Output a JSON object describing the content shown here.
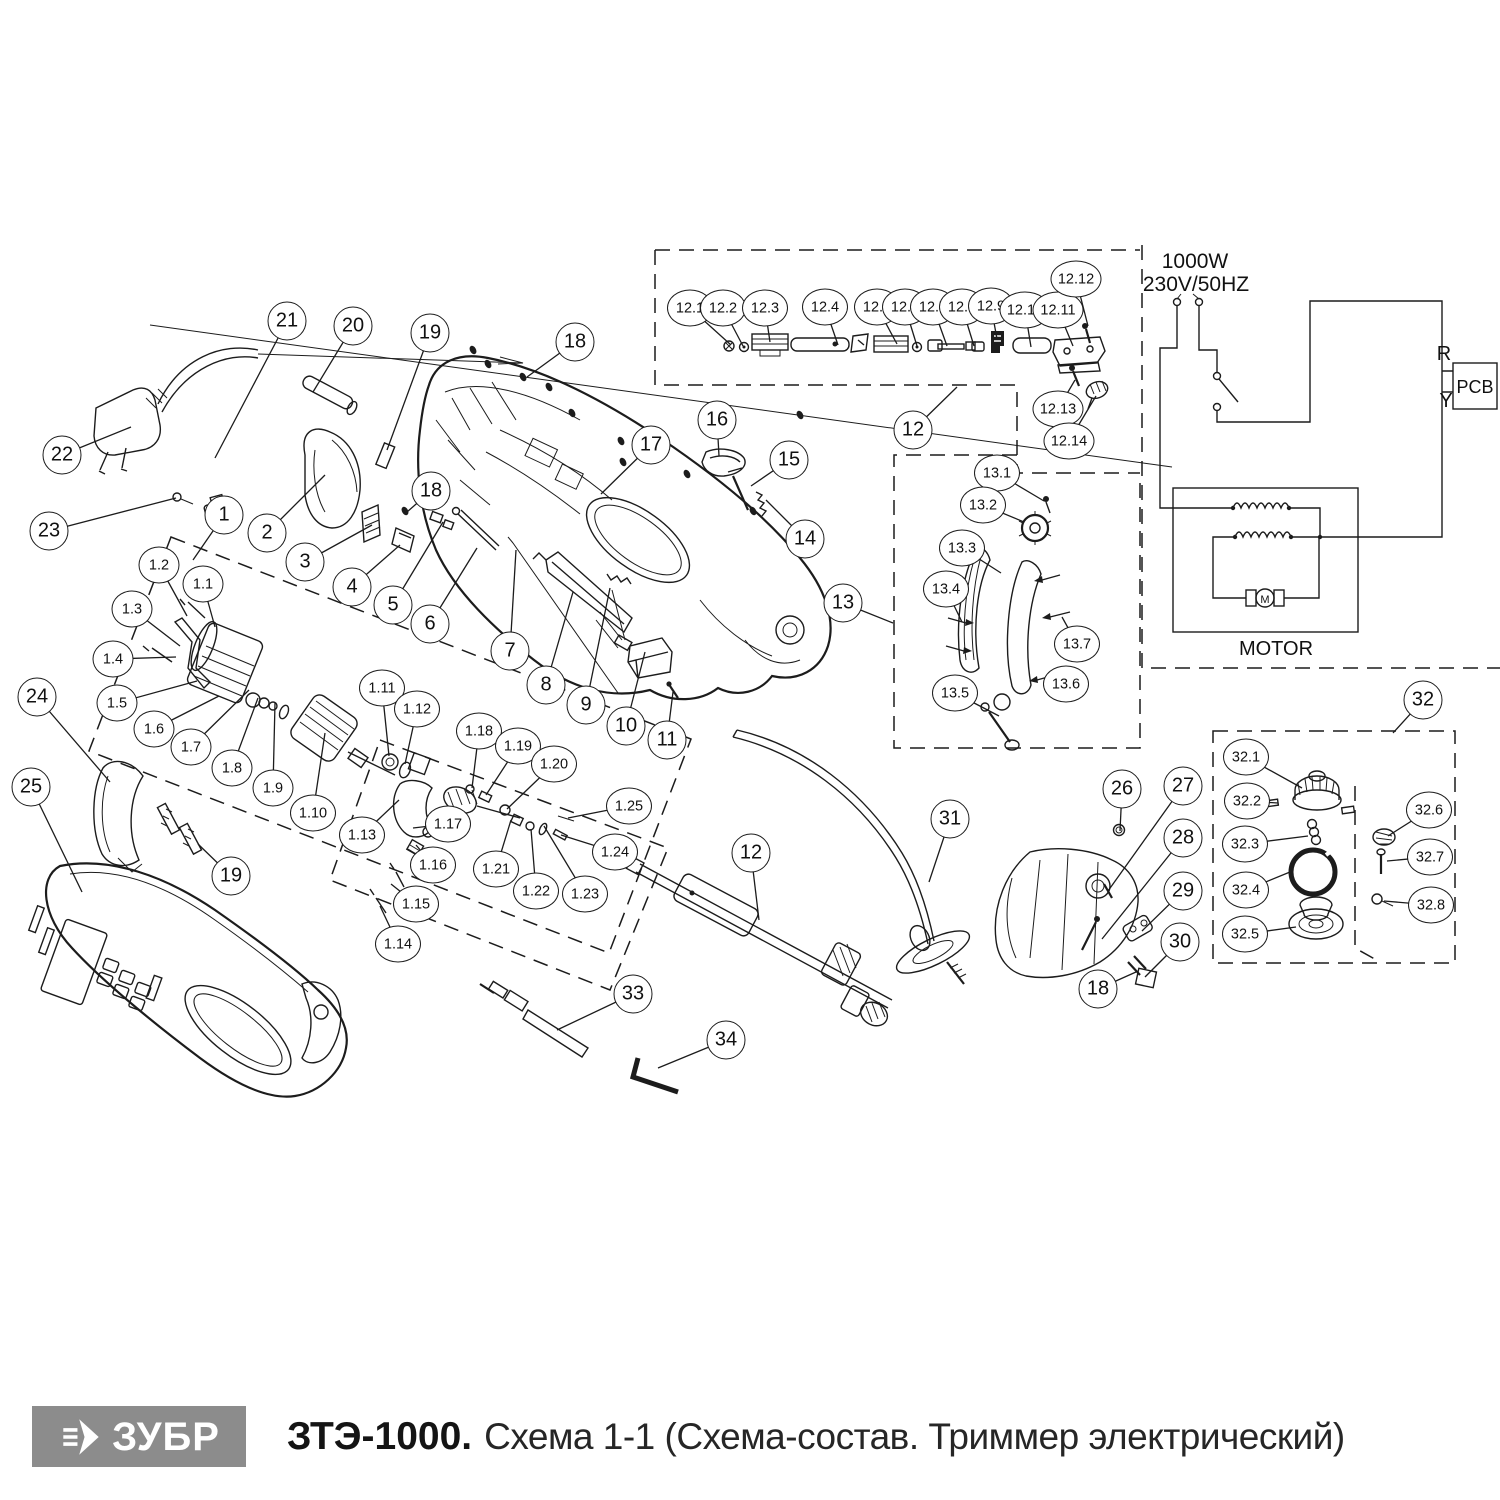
{
  "footer": {
    "brand": "ЗУБР",
    "model": "ЗТЭ-1000.",
    "subtitle": "Схема 1-1 (Схема-состав. Триммер электрический)"
  },
  "schematic": {
    "power": "1000W",
    "voltage": "230V/50HZ",
    "r_label": "R",
    "y_label": "Y",
    "pcb_label": "PCB",
    "motor_label": "MOTOR",
    "motor_symbol": "M"
  },
  "colors": {
    "line": "#1c1c1c",
    "logo_bg": "#8c8c8c",
    "background": "#ffffff"
  },
  "callouts": [
    {
      "label": "1",
      "x": 224,
      "y": 515,
      "tx": 193,
      "ty": 560
    },
    {
      "label": "2",
      "x": 267,
      "y": 533,
      "tx": 325,
      "ty": 475
    },
    {
      "label": "3",
      "x": 305,
      "y": 562,
      "tx": 372,
      "ty": 525
    },
    {
      "label": "4",
      "x": 352,
      "y": 587,
      "tx": 400,
      "ty": 545
    },
    {
      "label": "5",
      "x": 393,
      "y": 605,
      "tx": 443,
      "ty": 522
    },
    {
      "label": "6",
      "x": 430,
      "y": 624,
      "tx": 477,
      "ty": 548
    },
    {
      "label": "7",
      "x": 510,
      "y": 651,
      "tx": 516,
      "ty": 550
    },
    {
      "label": "8",
      "x": 546,
      "y": 685,
      "tx": 573,
      "ty": 592
    },
    {
      "label": "9",
      "x": 586,
      "y": 705,
      "tx": 610,
      "ty": 588
    },
    {
      "label": "10",
      "x": 626,
      "y": 726,
      "tx": 645,
      "ty": 652
    },
    {
      "label": "11",
      "x": 667,
      "y": 740,
      "tx": 673,
      "ty": 692
    },
    {
      "label": "12",
      "x": 913,
      "y": 430,
      "tx": 957,
      "ty": 387
    },
    {
      "label": "12",
      "x": 751,
      "y": 853,
      "tx": 759,
      "ty": 920
    },
    {
      "label": "13",
      "x": 843,
      "y": 603,
      "tx": 893,
      "ty": 623
    },
    {
      "label": "14",
      "x": 805,
      "y": 539,
      "tx": 766,
      "ty": 500
    },
    {
      "label": "15",
      "x": 789,
      "y": 460,
      "tx": 751,
      "ty": 486
    },
    {
      "label": "16",
      "x": 717,
      "y": 420,
      "tx": 719,
      "ty": 456
    },
    {
      "label": "17",
      "x": 651,
      "y": 445,
      "tx": 601,
      "ty": 494
    },
    {
      "label": "18",
      "x": 575,
      "y": 342,
      "tx": 527,
      "ty": 377
    },
    {
      "label": "18",
      "x": 431,
      "y": 491,
      "tx": 407,
      "ty": 512
    },
    {
      "label": "18",
      "x": 1098,
      "y": 989,
      "tx": 1136,
      "ty": 972
    },
    {
      "label": "19",
      "x": 430,
      "y": 333,
      "tx": 387,
      "ty": 450
    },
    {
      "label": "19",
      "x": 231,
      "y": 876,
      "tx": 198,
      "ty": 844
    },
    {
      "label": "20",
      "x": 353,
      "y": 326,
      "tx": 313,
      "ty": 392
    },
    {
      "label": "21",
      "x": 287,
      "y": 321,
      "tx": 215,
      "ty": 458
    },
    {
      "label": "22",
      "x": 62,
      "y": 455,
      "tx": 131,
      "ty": 427
    },
    {
      "label": "23",
      "x": 49,
      "y": 531,
      "tx": 176,
      "ty": 498
    },
    {
      "label": "24",
      "x": 37,
      "y": 697,
      "tx": 110,
      "ty": 782
    },
    {
      "label": "25",
      "x": 31,
      "y": 787,
      "tx": 82,
      "ty": 892
    },
    {
      "label": "26",
      "x": 1122,
      "y": 789,
      "tx": 1120,
      "ty": 831
    },
    {
      "label": "27",
      "x": 1183,
      "y": 786,
      "tx": 1108,
      "ty": 891
    },
    {
      "label": "28",
      "x": 1183,
      "y": 838,
      "tx": 1102,
      "ty": 939
    },
    {
      "label": "29",
      "x": 1183,
      "y": 891,
      "tx": 1142,
      "ty": 931
    },
    {
      "label": "30",
      "x": 1180,
      "y": 942,
      "tx": 1145,
      "ty": 977
    },
    {
      "label": "31",
      "x": 950,
      "y": 819,
      "tx": 929,
      "ty": 882
    },
    {
      "label": "32",
      "x": 1423,
      "y": 700,
      "tx": 1393,
      "ty": 733
    },
    {
      "label": "33",
      "x": 633,
      "y": 994,
      "tx": 557,
      "ty": 1030
    },
    {
      "label": "34",
      "x": 726,
      "y": 1040,
      "tx": 658,
      "ty": 1068
    },
    {
      "label": "1.1",
      "x": 203,
      "y": 584,
      "tx": 215,
      "ty": 627
    },
    {
      "label": "1.2",
      "x": 159,
      "y": 565,
      "tx": 187,
      "ty": 616
    },
    {
      "label": "1.3",
      "x": 132,
      "y": 609,
      "tx": 180,
      "ty": 646
    },
    {
      "label": "1.4",
      "x": 113,
      "y": 659,
      "tx": 176,
      "ty": 657
    },
    {
      "label": "1.5",
      "x": 117,
      "y": 703,
      "tx": 197,
      "ty": 681
    },
    {
      "label": "1.6",
      "x": 154,
      "y": 729,
      "tx": 219,
      "ty": 696
    },
    {
      "label": "1.7",
      "x": 191,
      "y": 747,
      "tx": 249,
      "ty": 690
    },
    {
      "label": "1.8",
      "x": 232,
      "y": 768,
      "tx": 258,
      "ty": 698
    },
    {
      "label": "1.9",
      "x": 273,
      "y": 788,
      "tx": 275,
      "ty": 703
    },
    {
      "label": "1.10",
      "x": 313,
      "y": 813,
      "tx": 325,
      "ty": 733
    },
    {
      "label": "1.11",
      "x": 382,
      "y": 688,
      "tx": 389,
      "ty": 756
    },
    {
      "label": "1.12",
      "x": 417,
      "y": 709,
      "tx": 405,
      "ty": 764
    },
    {
      "label": "1.13",
      "x": 362,
      "y": 835,
      "tx": 399,
      "ty": 800
    },
    {
      "label": "1.14",
      "x": 398,
      "y": 944,
      "tx": 380,
      "ty": 906
    },
    {
      "label": "1.15",
      "x": 416,
      "y": 904,
      "tx": 391,
      "ty": 884
    },
    {
      "label": "1.16",
      "x": 433,
      "y": 865,
      "tx": 416,
      "ty": 845
    },
    {
      "label": "1.17",
      "x": 448,
      "y": 824,
      "tx": 413,
      "ty": 828
    },
    {
      "label": "1.18",
      "x": 479,
      "y": 731,
      "tx": 472,
      "ty": 788
    },
    {
      "label": "1.19",
      "x": 518,
      "y": 746,
      "tx": 486,
      "ty": 795
    },
    {
      "label": "1.20",
      "x": 554,
      "y": 764,
      "tx": 507,
      "ty": 809
    },
    {
      "label": "1.21",
      "x": 496,
      "y": 869,
      "tx": 511,
      "ty": 820
    },
    {
      "label": "1.22",
      "x": 536,
      "y": 891,
      "tx": 531,
      "ty": 829
    },
    {
      "label": "1.23",
      "x": 585,
      "y": 894,
      "tx": 544,
      "ty": 826
    },
    {
      "label": "1.24",
      "x": 615,
      "y": 852,
      "tx": 561,
      "ty": 835
    },
    {
      "label": "1.25",
      "x": 629,
      "y": 806,
      "tx": 568,
      "ty": 818
    },
    {
      "label": "12.1",
      "x": 690,
      "y": 308,
      "tx": 731,
      "ty": 345
    },
    {
      "label": "12.2",
      "x": 723,
      "y": 308,
      "tx": 743,
      "ty": 346
    },
    {
      "label": "12.3",
      "x": 765,
      "y": 308,
      "tx": 770,
      "ty": 342
    },
    {
      "label": "12.4",
      "x": 825,
      "y": 307,
      "tx": 838,
      "ty": 345
    },
    {
      "label": "12.5",
      "x": 877,
      "y": 307,
      "tx": 897,
      "ty": 344
    },
    {
      "label": "12.6",
      "x": 905,
      "y": 307,
      "tx": 917,
      "ty": 346
    },
    {
      "label": "12.7",
      "x": 933,
      "y": 307,
      "tx": 947,
      "ty": 346
    },
    {
      "label": "12.8",
      "x": 962,
      "y": 307,
      "tx": 974,
      "ty": 346
    },
    {
      "label": "12.9",
      "x": 991,
      "y": 306,
      "tx": 997,
      "ty": 339
    },
    {
      "label": "12.10",
      "x": 1025,
      "y": 310,
      "tx": 1031,
      "ty": 347
    },
    {
      "label": "12.11",
      "x": 1058,
      "y": 310,
      "tx": 1073,
      "ty": 346
    },
    {
      "label": "12.12",
      "x": 1076,
      "y": 279,
      "tx": 1088,
      "ty": 326
    },
    {
      "label": "12.13",
      "x": 1058,
      "y": 409,
      "tx": 1075,
      "ty": 380
    },
    {
      "label": "12.14",
      "x": 1069,
      "y": 441,
      "tx": 1096,
      "ty": 396
    },
    {
      "label": "13.1",
      "x": 997,
      "y": 473,
      "tx": 1044,
      "ty": 501
    },
    {
      "label": "13.2",
      "x": 983,
      "y": 505,
      "tx": 1024,
      "ty": 522
    },
    {
      "label": "13.3",
      "x": 962,
      "y": 548,
      "tx": 1001,
      "ty": 573
    },
    {
      "label": "13.4",
      "x": 946,
      "y": 589,
      "tx": 962,
      "ty": 622
    },
    {
      "label": "13.5",
      "x": 955,
      "y": 693,
      "tx": 999,
      "ty": 716
    },
    {
      "label": "13.6",
      "x": 1066,
      "y": 684,
      "tx": 1047,
      "ty": 675
    },
    {
      "label": "13.7",
      "x": 1077,
      "y": 644,
      "tx": 1062,
      "ty": 617
    },
    {
      "label": "32.1",
      "x": 1246,
      "y": 757,
      "tx": 1302,
      "ty": 788
    },
    {
      "label": "32.2",
      "x": 1247,
      "y": 801,
      "tx": 1278,
      "ty": 803
    },
    {
      "label": "32.3",
      "x": 1245,
      "y": 844,
      "tx": 1308,
      "ty": 836
    },
    {
      "label": "32.4",
      "x": 1246,
      "y": 890,
      "tx": 1290,
      "ty": 872
    },
    {
      "label": "32.5",
      "x": 1245,
      "y": 934,
      "tx": 1296,
      "ty": 927
    },
    {
      "label": "32.6",
      "x": 1429,
      "y": 810,
      "tx": 1388,
      "ty": 836
    },
    {
      "label": "32.7",
      "x": 1430,
      "y": 857,
      "tx": 1387,
      "ty": 861
    },
    {
      "label": "32.8",
      "x": 1431,
      "y": 905,
      "tx": 1384,
      "ty": 901
    }
  ]
}
